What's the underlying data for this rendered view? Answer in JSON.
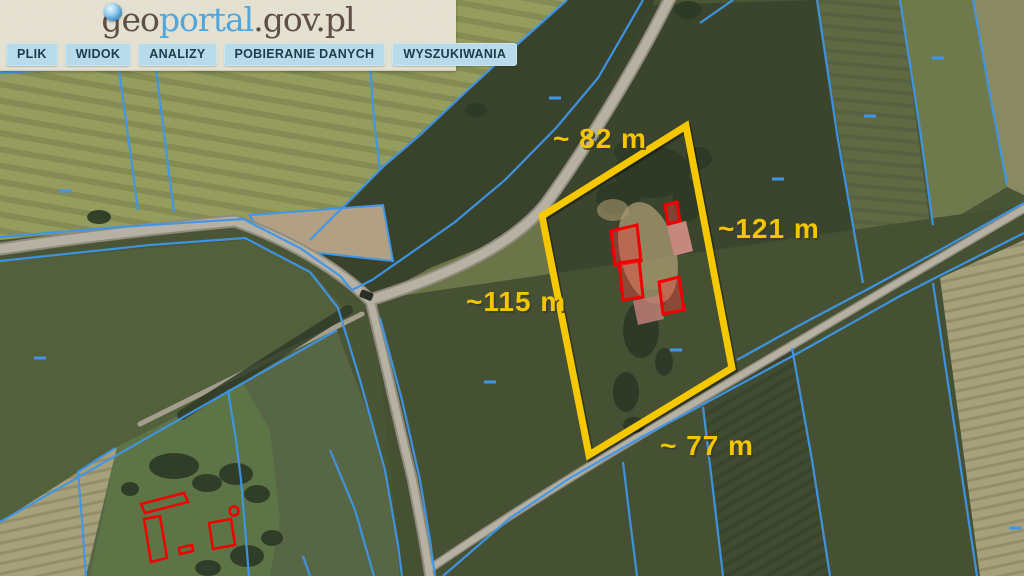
{
  "header": {
    "logo": {
      "part1": "geo",
      "part2": "portal",
      "part3": ".gov.pl"
    },
    "menu": [
      {
        "label": "PLIK"
      },
      {
        "label": "WIDOK"
      },
      {
        "label": "ANALIZY"
      },
      {
        "label": "POBIERANIE DANYCH"
      },
      {
        "label": "WYSZUKIWANIA"
      }
    ]
  },
  "map": {
    "measurements": [
      {
        "side": "top",
        "text": "~ 82 m"
      },
      {
        "side": "right",
        "text": "~121 m"
      },
      {
        "side": "left",
        "text": "~115 m"
      },
      {
        "side": "bottom",
        "text": "~ 77 m"
      }
    ],
    "colors": {
      "parcel_highlight": "#f6c800",
      "cadastral_line": "#3f96e8",
      "building_outline": "#f00000",
      "measurement_text": "#f3c600"
    }
  }
}
